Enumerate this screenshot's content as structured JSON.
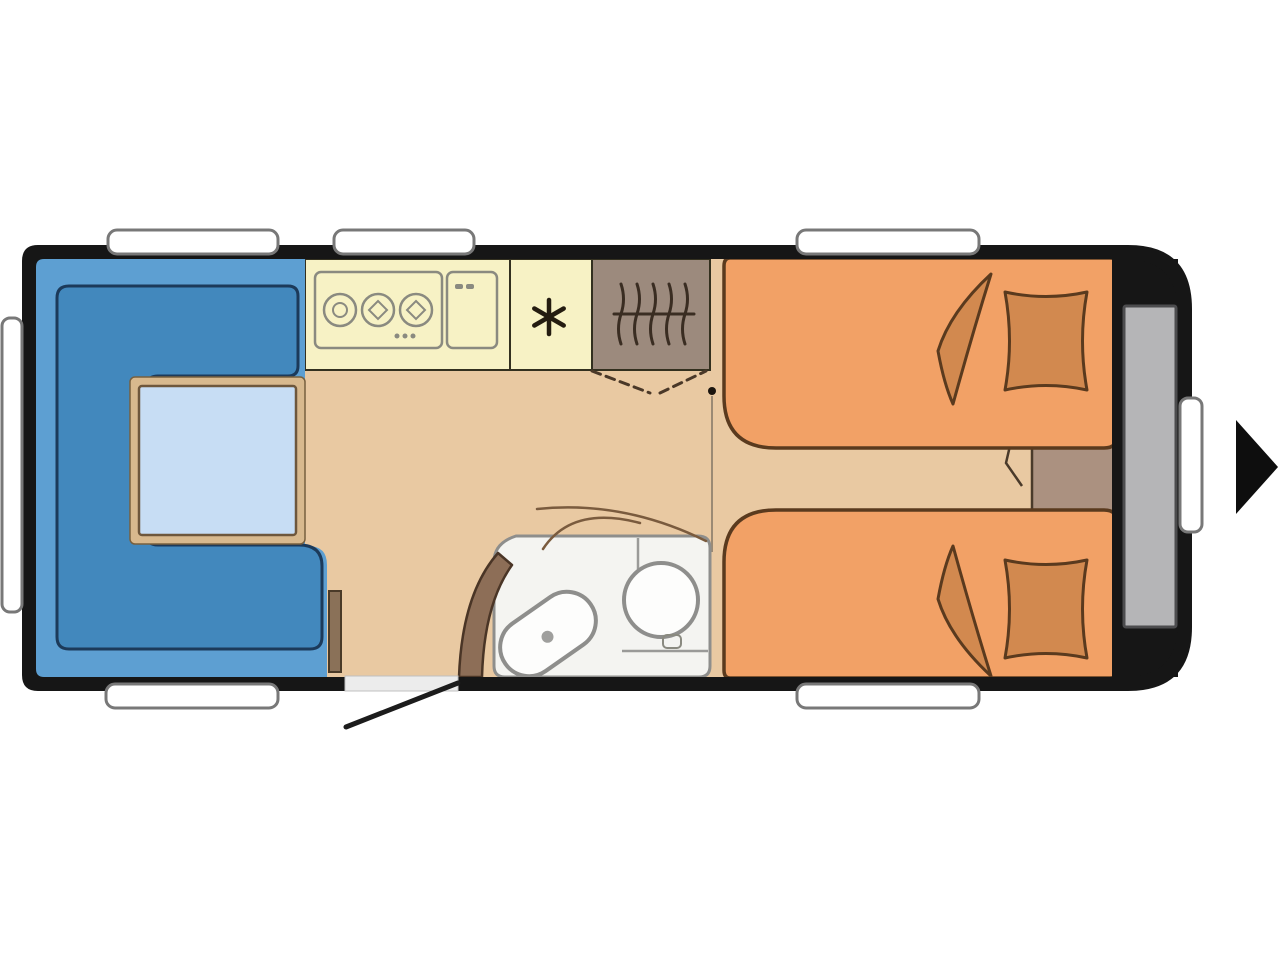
{
  "image": {
    "kind": "caravan-floorplan-diagram",
    "view": "top-down"
  },
  "colors": {
    "canvas": "#ffffff",
    "shell": "#161616",
    "floor": "#e9c9a2",
    "seating": "#5d9fd2",
    "cushion": "#4288bd",
    "table_rim": "#d8b98e",
    "table_top": "#c7ddf4",
    "kitchen_unit": "#f7f2c5",
    "appliance_white": "#fcfcf9",
    "burner_inner": "#ececе6",
    "wardrobe": "#9c8a7d",
    "bed": "#f2a166",
    "bedding": "#d2894f",
    "bedside_cabinet": "#ab9180",
    "bathroom_floor": "#f4f4f1",
    "fixture": "#fdfdfc",
    "fixture_dot": "#9f9f9d",
    "bathroom_door": "#8d6e57",
    "rear_storage": "#b5b5b7",
    "window": "#ffffff",
    "threshold": "#ececec",
    "side_seat_trim": "#8a7158",
    "arrow": "#0e0e0e"
  },
  "icons": {
    "fridge": "snowflake",
    "wardrobe": "hanging-clothes-rail",
    "hob": "three-burner-hob",
    "navigation": "right-arrow"
  },
  "areas": [
    {
      "id": "lounge",
      "label": "front-lounge-u-seating-with-table"
    },
    {
      "id": "kitchen",
      "label": "kitchen-hob-and-sink"
    },
    {
      "id": "fridge",
      "label": "refrigerator"
    },
    {
      "id": "wardrobe",
      "label": "wardrobe"
    },
    {
      "id": "bathroom",
      "label": "washroom-toilet-and-basin"
    },
    {
      "id": "bedroom",
      "label": "twin-single-beds-with-bedside-cabinet"
    },
    {
      "id": "storage",
      "label": "rear-storage"
    },
    {
      "id": "entry",
      "label": "entry-door-with-swing"
    }
  ],
  "window_count": 7
}
